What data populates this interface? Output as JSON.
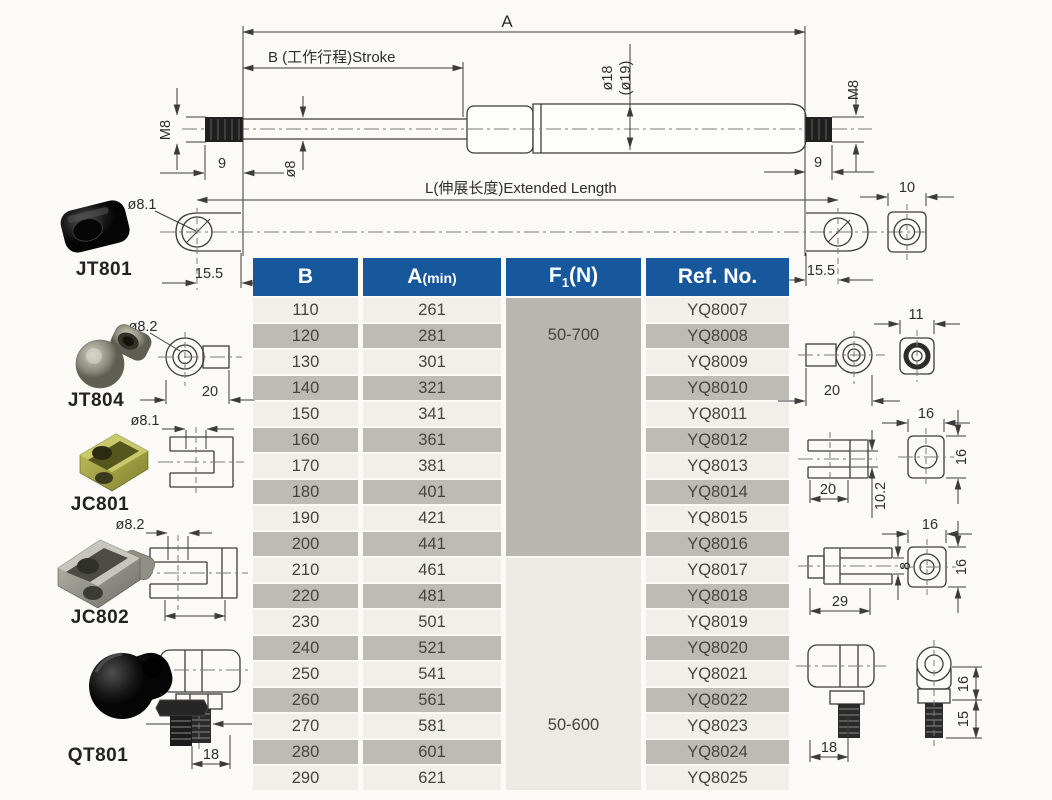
{
  "colors": {
    "header_blue": "#17589c",
    "header_text": "#ffffff",
    "row_light": "#f0efe9",
    "row_dark": "#bdbcb4",
    "f1_cell_gray": "#b8b7af",
    "f1_cell_light": "#ebeae4",
    "line_color": "#3c3c3c",
    "page_bg": "#fbfaf6"
  },
  "drawing": {
    "a_label": "A",
    "b_label": "B (工作行程)Stroke",
    "l_label": "L(伸展长度)Extended Length",
    "m8_left": "M8",
    "m8_right": "M8",
    "nine_left": "9",
    "nine_right": "9",
    "rod_dia": "ø8",
    "tube_dia": "ø18",
    "tube_dia_alt": "(ø19)"
  },
  "fittings_left": [
    {
      "name": "JT801",
      "hole_dia": "ø8.1",
      "eyelet_width": "15.5"
    },
    {
      "name": "JT804",
      "hole_dia": "ø8.2",
      "width": "20"
    },
    {
      "name": "JC801",
      "hole_dia": "ø8.1"
    },
    {
      "name": "JC802",
      "hole_dia": "ø8.2"
    },
    {
      "name": "QT801",
      "stud_len": "18"
    }
  ],
  "fittings_right": {
    "eyelet_width": "15.5",
    "eyelet_thickness": "10",
    "socket_width": "20",
    "socket_thickness": "11",
    "clevis1_width": "20",
    "clevis1_slot": "10.2",
    "clevis1_face_w": "16",
    "clevis1_face_h": "16",
    "clevis2_width": "29",
    "clevis2_pin": "8",
    "clevis2_face_w": "16",
    "clevis2_face_h": "16",
    "balljoint_width": "18",
    "balljoint_height": "16",
    "balljoint_stud": "15"
  },
  "table": {
    "headers": {
      "b": "B",
      "a": "A",
      "a_sub": "(min)",
      "f": "F",
      "f_sub": "1",
      "f_tail": "(N)",
      "ref": "Ref. No."
    },
    "f1_groups": [
      {
        "force": "50-700"
      },
      {
        "force": "50-600"
      }
    ],
    "rows": [
      {
        "b": "110",
        "a": "261",
        "ref": "YQ8007"
      },
      {
        "b": "120",
        "a": "281",
        "ref": "YQ8008"
      },
      {
        "b": "130",
        "a": "301",
        "ref": "YQ8009"
      },
      {
        "b": "140",
        "a": "321",
        "ref": "YQ8010"
      },
      {
        "b": "150",
        "a": "341",
        "ref": "YQ8011"
      },
      {
        "b": "160",
        "a": "361",
        "ref": "YQ8012"
      },
      {
        "b": "170",
        "a": "381",
        "ref": "YQ8013"
      },
      {
        "b": "180",
        "a": "401",
        "ref": "YQ8014"
      },
      {
        "b": "190",
        "a": "421",
        "ref": "YQ8015"
      },
      {
        "b": "200",
        "a": "441",
        "ref": "YQ8016"
      },
      {
        "b": "210",
        "a": "461",
        "ref": "YQ8017"
      },
      {
        "b": "220",
        "a": "481",
        "ref": "YQ8018"
      },
      {
        "b": "230",
        "a": "501",
        "ref": "YQ8019"
      },
      {
        "b": "240",
        "a": "521",
        "ref": "YQ8020"
      },
      {
        "b": "250",
        "a": "541",
        "ref": "YQ8021"
      },
      {
        "b": "260",
        "a": "561",
        "ref": "YQ8022"
      },
      {
        "b": "270",
        "a": "581",
        "ref": "YQ8023"
      },
      {
        "b": "280",
        "a": "601",
        "ref": "YQ8024"
      },
      {
        "b": "290",
        "a": "621",
        "ref": "YQ8025"
      }
    ]
  }
}
